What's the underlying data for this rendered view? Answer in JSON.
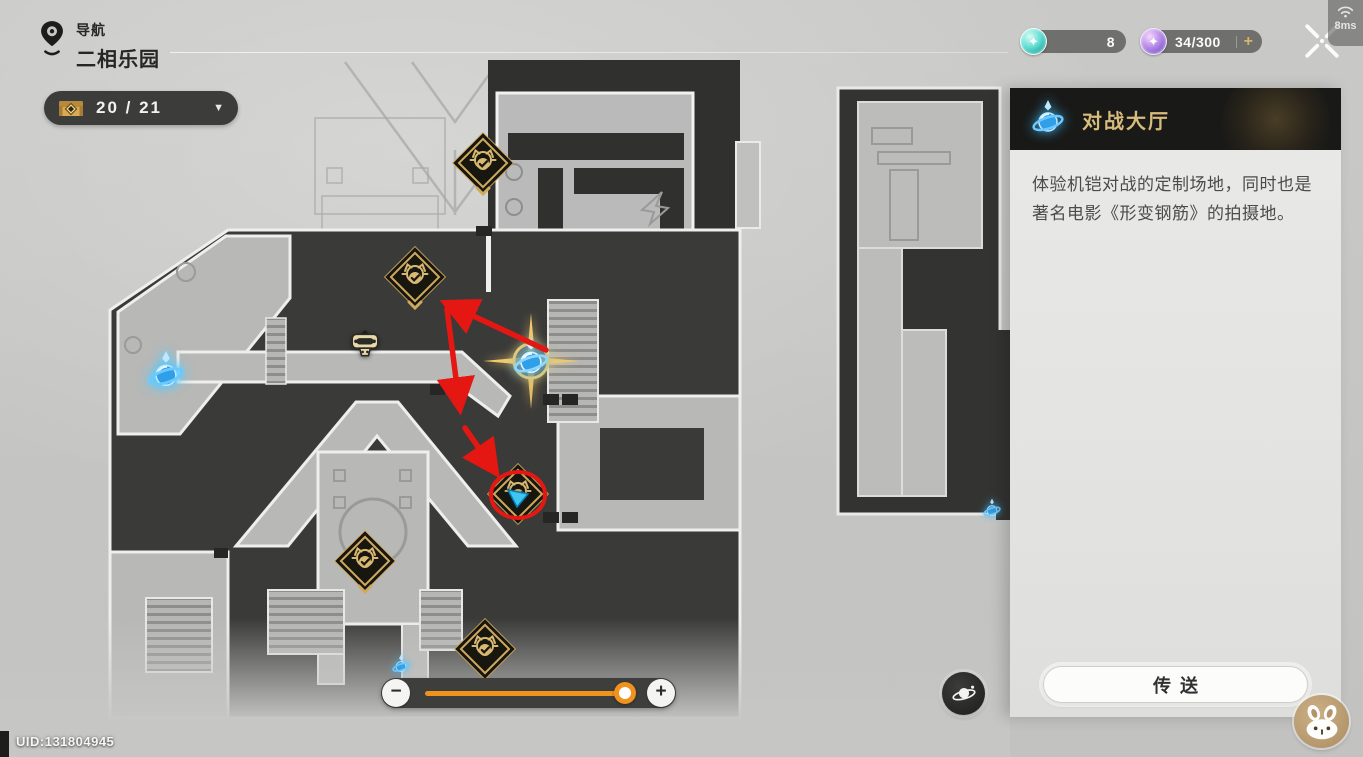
{
  "header": {
    "nav_label": "导航",
    "location_name": "二相乐园",
    "ping": "8ms",
    "currencies": [
      {
        "name": "trailblaze-power",
        "value": "8"
      },
      {
        "name": "reserved-power",
        "value": "34/300",
        "plus_label": "+"
      }
    ]
  },
  "chest_counter": {
    "value": "20 / 21",
    "caret": "▼"
  },
  "panel": {
    "title": "对战大厅",
    "description": "体验机铠对战的定制场地，同时也是著名电影《形变钢筋》的拍摄地。",
    "teleport_label": "传送"
  },
  "slider": {
    "value_percent": 96,
    "zoom_out_label": "−",
    "zoom_in_label": "+"
  },
  "map": {
    "uid": "UID:131804945",
    "markers": [
      {
        "type": "enemy",
        "x": 483,
        "y": 163,
        "chevron": true
      },
      {
        "type": "enemy",
        "x": 415,
        "y": 277,
        "chevron": true
      },
      {
        "type": "enemy",
        "x": 365,
        "y": 561,
        "chevron": true
      },
      {
        "type": "enemy",
        "x": 485,
        "y": 649,
        "chevron": false
      },
      {
        "type": "enemy",
        "x": 518,
        "y": 494,
        "chevron": false,
        "cyan_arrow": true
      },
      {
        "type": "npc-robot",
        "x": 365,
        "y": 345
      },
      {
        "type": "anchor",
        "x": 166,
        "y": 372
      },
      {
        "type": "anchor-selected",
        "x": 531,
        "y": 361
      },
      {
        "type": "anchor-small",
        "x": 401,
        "y": 665
      },
      {
        "type": "anchor-small",
        "x": 992,
        "y": 509
      }
    ],
    "annotations": {
      "color": "#e41712",
      "arrows": [
        {
          "x1": 546,
          "y1": 350,
          "x2": 452,
          "y2": 306
        },
        {
          "x1": 447,
          "y1": 309,
          "x2": 459,
          "y2": 402
        },
        {
          "x1": 465,
          "y1": 428,
          "x2": 492,
          "y2": 467
        }
      ],
      "circle": {
        "cx": 518,
        "cy": 495,
        "rx": 27,
        "ry": 23
      }
    }
  },
  "icons": {
    "nav_pin": "location-pin-icon",
    "chest": "chest-icon",
    "wifi": "wifi-icon",
    "close": "close-icon",
    "teleport_anchor": "space-anchor-icon",
    "anchor_list": "planet-orbit-icon",
    "assistant": "rabbit-face-icon"
  }
}
